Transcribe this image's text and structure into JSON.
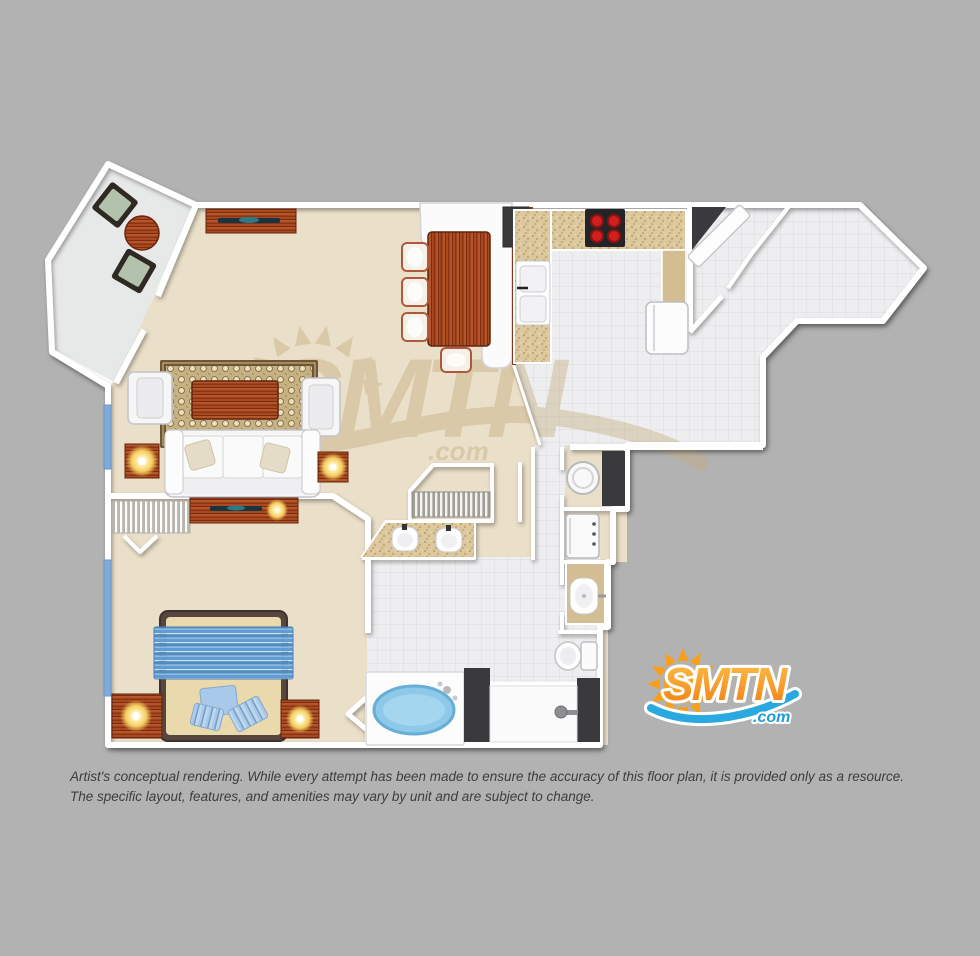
{
  "page": {
    "background": "#b2b2b2",
    "type": "floor-plan-rendering"
  },
  "branding": {
    "logo": {
      "name": "SMTN",
      "suffix": ".com",
      "orange": "#f7941e",
      "orange_light": "#fdc14b",
      "orange_dark": "#f07d12",
      "blue": "#2aa9e0",
      "blue_dark": "#1f9cd7"
    },
    "watermark": {
      "name": "SMTN",
      "suffix": ".com",
      "color": "#c9b388"
    }
  },
  "disclaimer": {
    "line1": "Artist's conceptual rendering. While every attempt has been made to ensure the accuracy of this floor plan, it is provided only as a resource.",
    "line2": "The specific layout, features, and amenities may vary by unit and are subject to change."
  },
  "floor_plan": {
    "rooms": [
      {
        "name": "balcony"
      },
      {
        "name": "living-room"
      },
      {
        "name": "dining-area"
      },
      {
        "name": "kitchen"
      },
      {
        "name": "entry-foyer"
      },
      {
        "name": "hallway"
      },
      {
        "name": "walk-in-closet"
      },
      {
        "name": "bathroom"
      },
      {
        "name": "laundry-closet"
      },
      {
        "name": "bedroom"
      }
    ],
    "furniture": [
      "patio-chairs",
      "patio-table",
      "media-console-tv",
      "area-rug",
      "coffee-table",
      "armchairs",
      "sofa",
      "end-tables-with-lamps",
      "dining-table",
      "dining-chairs",
      "breakfast-bar",
      "range-cooktop",
      "kitchen-sink",
      "refrigerator",
      "pantry-cabinet",
      "entry-door",
      "washer",
      "dryer",
      "utility-sink",
      "toilet",
      "shower",
      "jacuzzi-tub",
      "double-vanity",
      "closet-rod",
      "bed",
      "nightstands-with-lamps",
      "dresser-tv",
      "bifold-closet-doors",
      "windows"
    ],
    "colors": {
      "wall": "#ffffff",
      "carpet": "#eadfc9",
      "tile": "#eeeef0",
      "balcony": "#e7e8e8",
      "counter_speckled": "#dcc89f",
      "counter_plain": "#d3bd92",
      "wood": "#9c3e1c",
      "charcoal": "#3a3a3c",
      "bed_blue": "#5e9cd3",
      "pillow_blue": "#a9c9ea",
      "tub_blue": "#8ec9e9",
      "lamp_glow": "#f3cd5f",
      "burner_red": "#cf1f1f",
      "cushion_sage": "#b3c2ac",
      "window_blue": "#7fabdb",
      "furniture_white": "#f6f6f8"
    }
  }
}
